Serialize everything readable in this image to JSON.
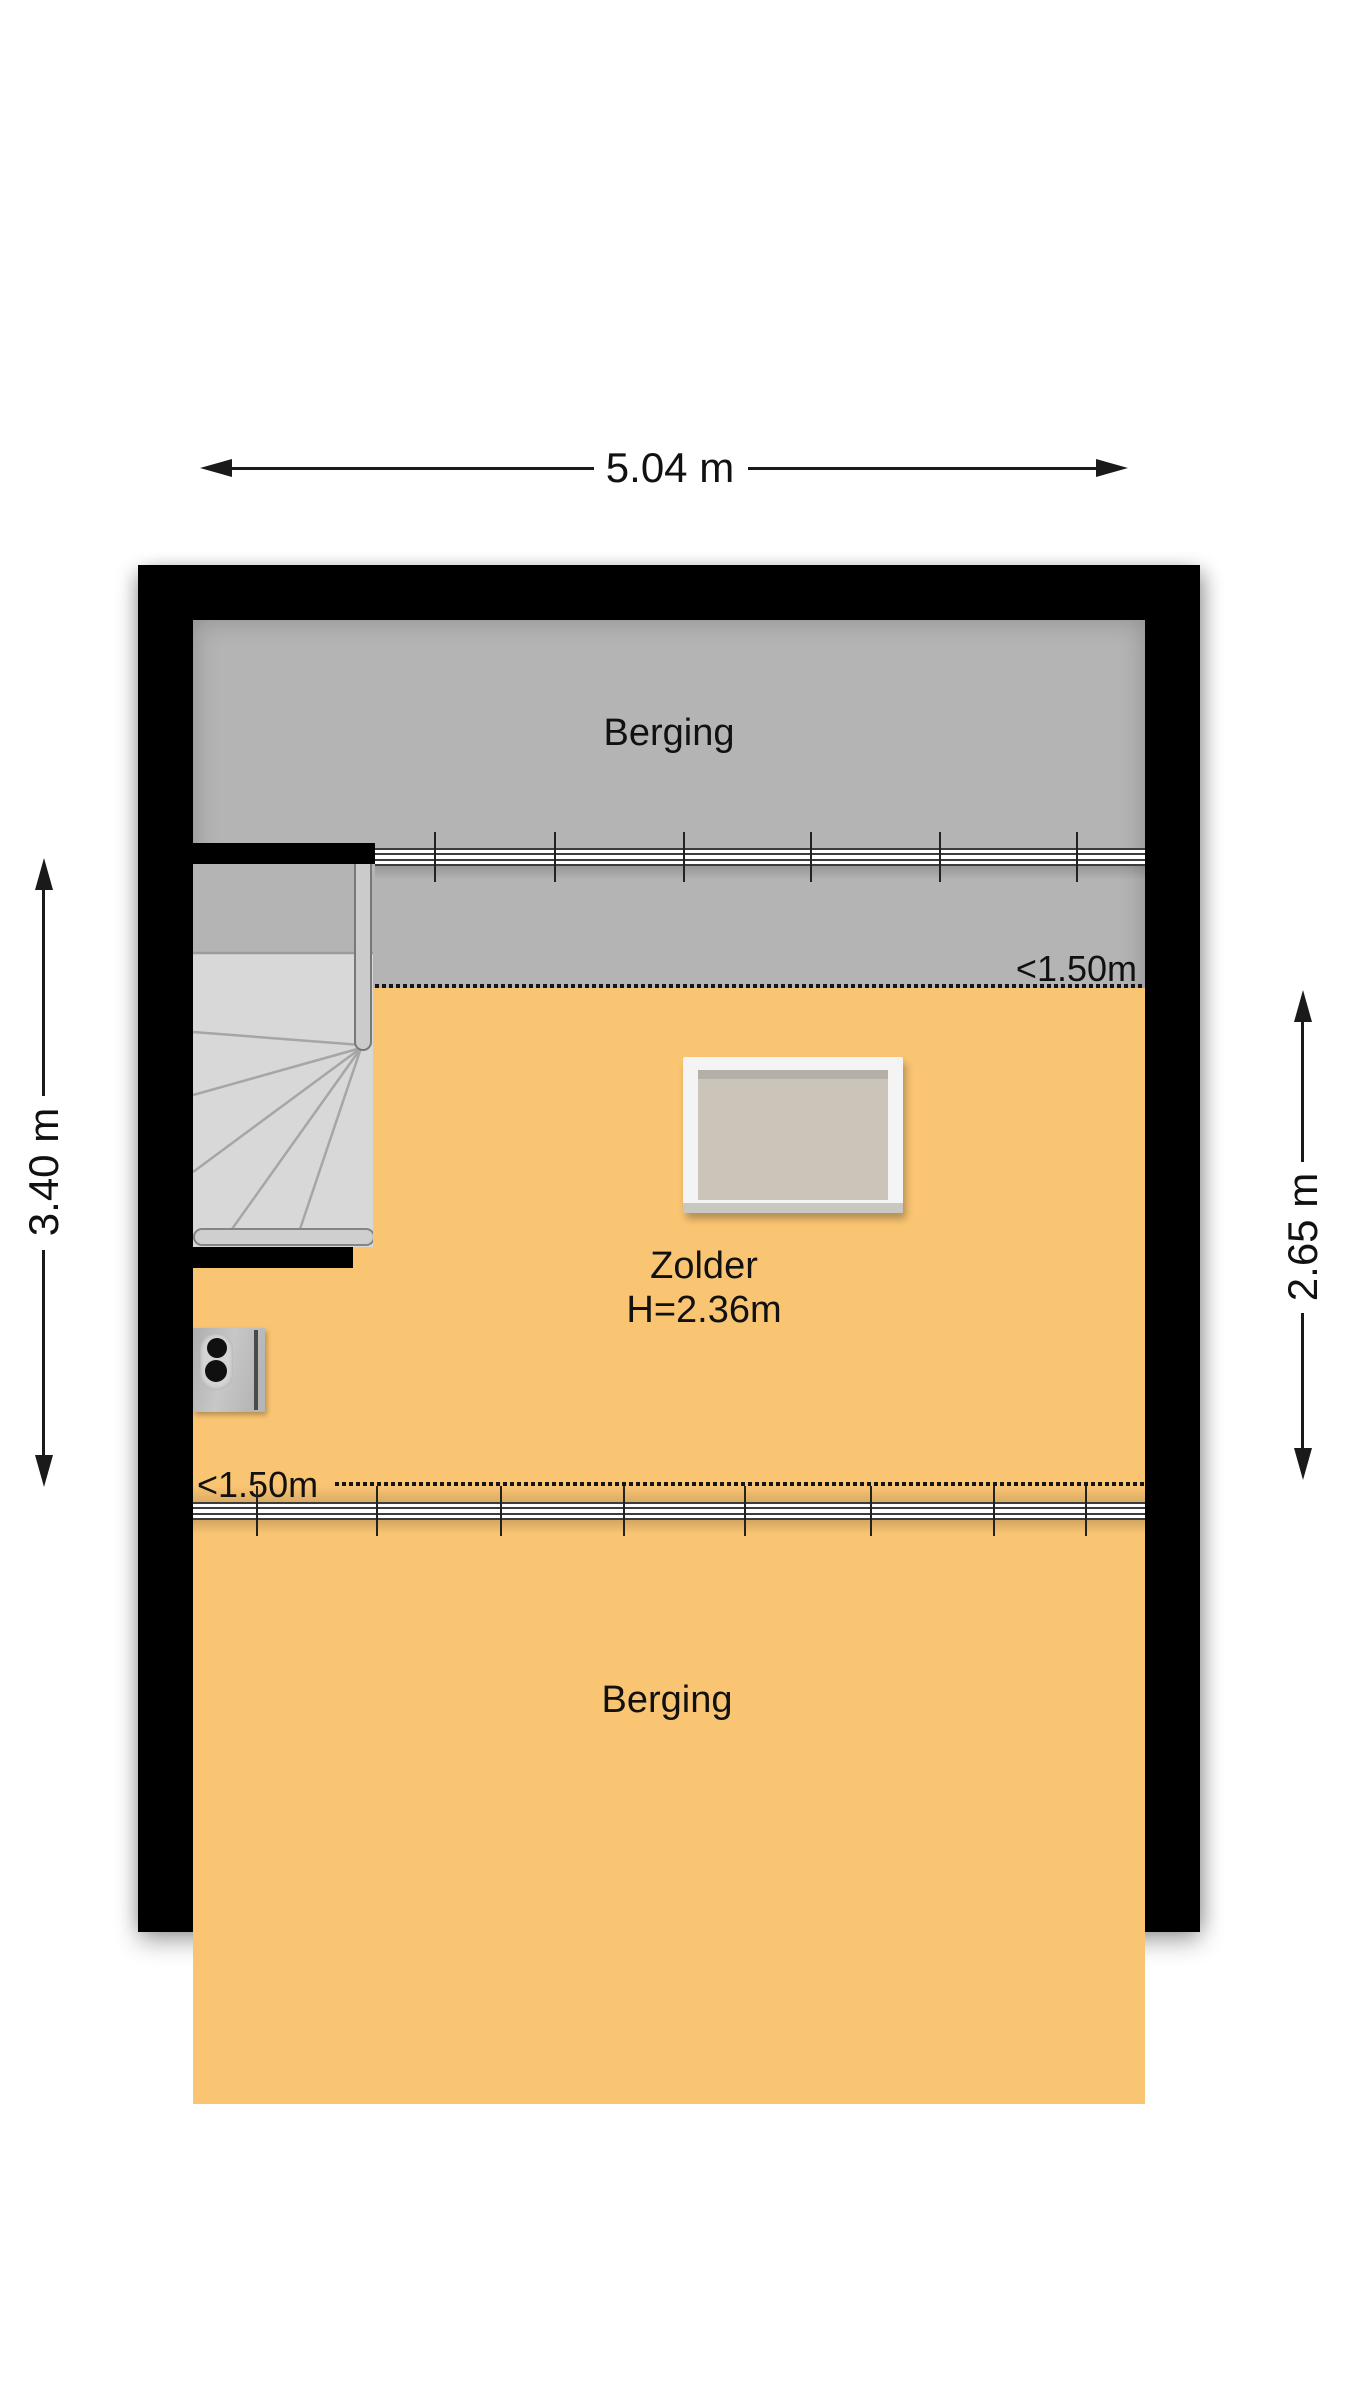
{
  "dimensions": {
    "top": "5.04 m",
    "left": "3.40 m",
    "right": "2.65 m"
  },
  "rooms": {
    "berging_top": {
      "label": "Berging"
    },
    "zolder": {
      "label": "Zolder",
      "height": "H=2.36m"
    },
    "berging_bottom": {
      "label": "Berging"
    }
  },
  "annotations": {
    "headroom_top": "<1.50m",
    "headroom_bottom": "<1.50m"
  },
  "colors": {
    "wall": "#000000",
    "berging_fill": "#b4b4b4",
    "zolder_fill": "#fac573",
    "stair_tread": "#d8d8d8",
    "skylight_frame": "#f4f4f4",
    "skylight_glass": "#cbc5b9",
    "background": "#ffffff",
    "text": "#111111"
  }
}
